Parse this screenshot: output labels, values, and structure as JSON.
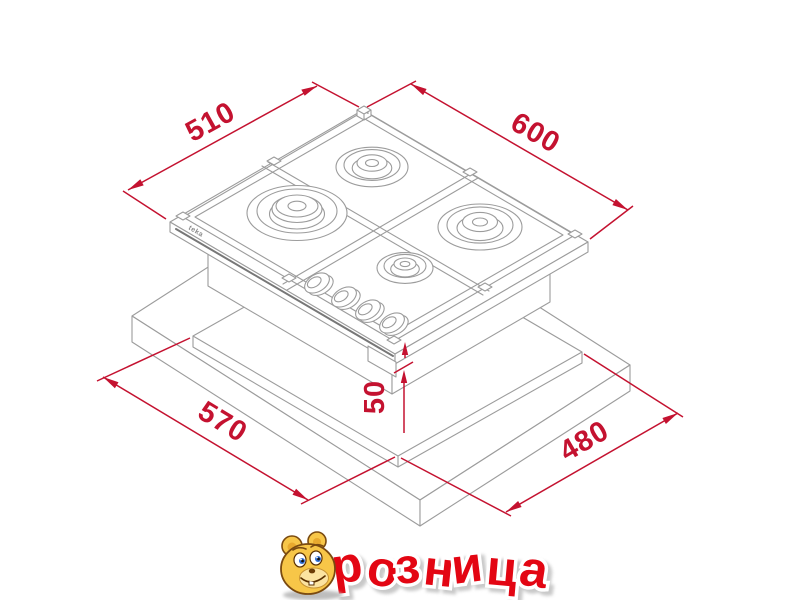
{
  "page": {
    "background": "#ffffff",
    "kind": "appliance installation drawing"
  },
  "diagram": {
    "subject": "4-burner built-in gas hob above worktop cutout, isometric view",
    "unit": "mm",
    "colors": {
      "line_gray": "#9c9c9c",
      "dimension_red": "#c41230"
    },
    "unit_values": {
      "d510": "510",
      "d600": "600",
      "d570": "570",
      "d480": "480",
      "d50": "50"
    },
    "hob": {
      "brand": "teka",
      "burner_count": 4,
      "knob_count": 4
    }
  },
  "footer_logo": {
    "brand": "розница",
    "visible_text": "розница",
    "text_color": "#e30613",
    "outline_color": "#ffffff",
    "mascot": "yellow-bear-face"
  }
}
